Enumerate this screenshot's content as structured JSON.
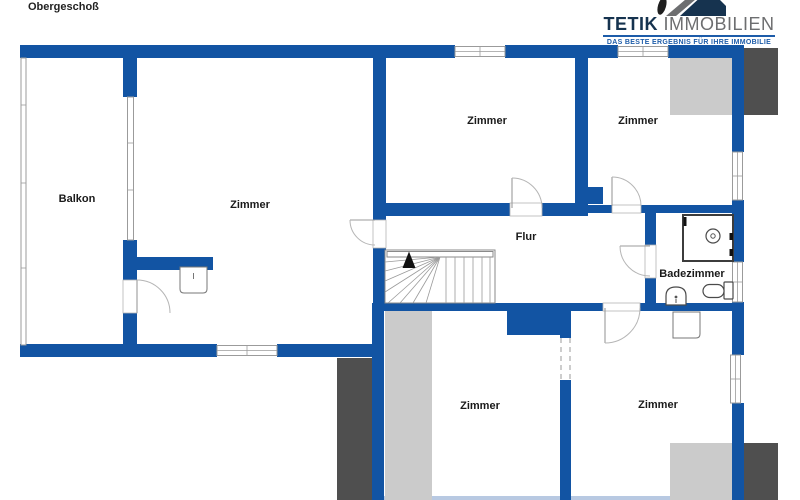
{
  "title": "Obergeschoß",
  "logo": {
    "brand_primary": "TETIK",
    "brand_secondary": "IMMOBILIEN",
    "tagline": "DAS BESTE ERGEBNIS FÜR IHRE IMMOBILIE",
    "icon": "house-roof-icon"
  },
  "rooms": {
    "balkon": "Balkon",
    "zimmer_left": "Zimmer",
    "zimmer_top_center": "Zimmer",
    "zimmer_top_right": "Zimmer",
    "flur": "Flur",
    "badezimmer": "Badezimmer",
    "zimmer_bottom_center": "Zimmer",
    "zimmer_bottom_right": "Zimmer"
  },
  "colors": {
    "wall": "#1254a3",
    "gray_light": "#cbcbcb",
    "gray_dark": "#4f4f4f",
    "frame": "#9b9b9b",
    "arc": "#b5b5b5",
    "fixture": "#4a4a4a",
    "text": "#1a1a1a",
    "brand_navy": "#16334f",
    "brand_gray": "#6d6e70",
    "brand_blue": "#1d5ca9",
    "cut_line": "#b8c9e2"
  }
}
